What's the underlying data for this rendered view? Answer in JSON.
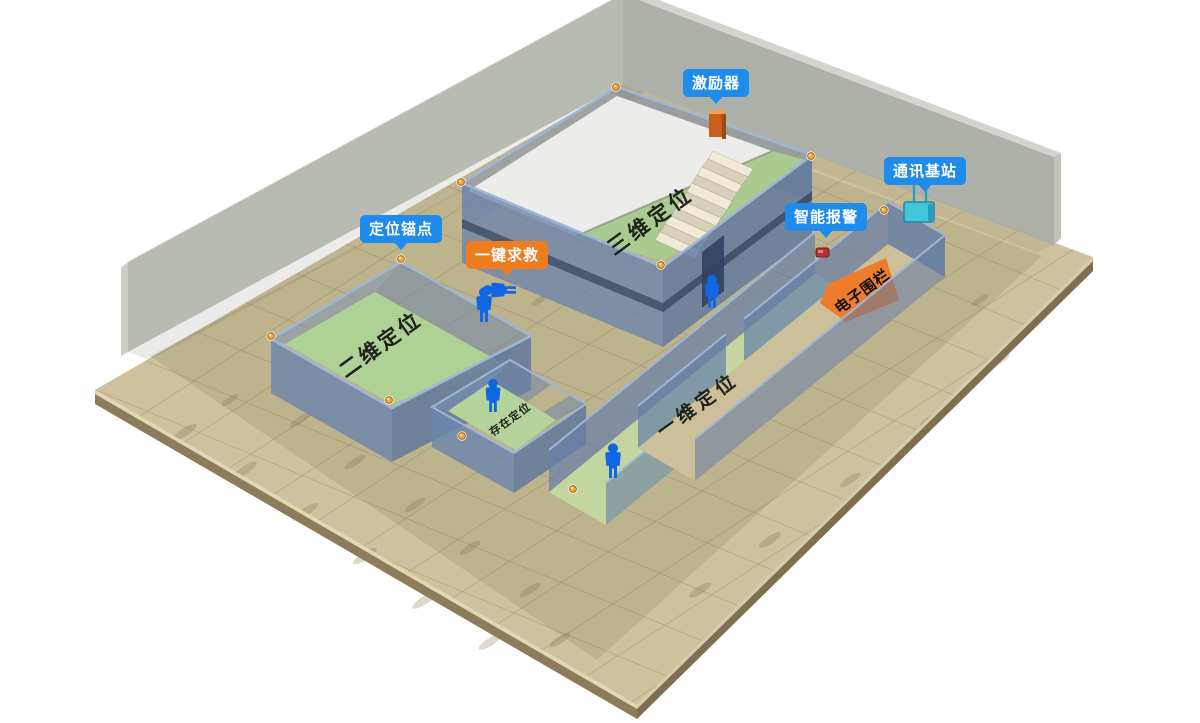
{
  "badges": [
    {
      "id": "exciter",
      "label": "激励器",
      "style": "blue"
    },
    {
      "id": "comm-base-station",
      "label": "通讯基站",
      "style": "blue"
    },
    {
      "id": "smart-alarm",
      "label": "智能报警",
      "style": "blue"
    },
    {
      "id": "positioning-anchor",
      "label": "定位锚点",
      "style": "blue"
    },
    {
      "id": "one-key-sos",
      "label": "一键求救",
      "style": "orange"
    }
  ],
  "zones": [
    {
      "id": "zone-3d",
      "label": "三维定位"
    },
    {
      "id": "zone-2d",
      "label": "二维定位"
    },
    {
      "id": "zone-presence",
      "label": "存在定位"
    },
    {
      "id": "zone-1d",
      "label": "一维定位"
    },
    {
      "id": "zone-fence",
      "label": "电子围栏"
    }
  ],
  "colors": {
    "badge_blue": "#1f8ceb",
    "badge_orange": "#ee7d1f",
    "fence_orange": "#ed7d2c",
    "room_floor_green": "#aed295",
    "corridor_green": "#c3d6a0",
    "mezzanine_white": "#ecedea",
    "wall_blue": "#6b8cb8",
    "ground_tan": "#cfc19d",
    "back_wall_gray": "#b4b7ae",
    "person_blue": "#1266e3",
    "anchor_amber": "#f2a93b"
  },
  "icons": {
    "person": "standing-person-pictogram",
    "person_down": "lying-person-pictogram",
    "anchor_dot": "amber-sphere",
    "exciter_device": "orange-box",
    "base_station_device": "cyan-box-two-antennas",
    "alarm_device": "red-box"
  }
}
